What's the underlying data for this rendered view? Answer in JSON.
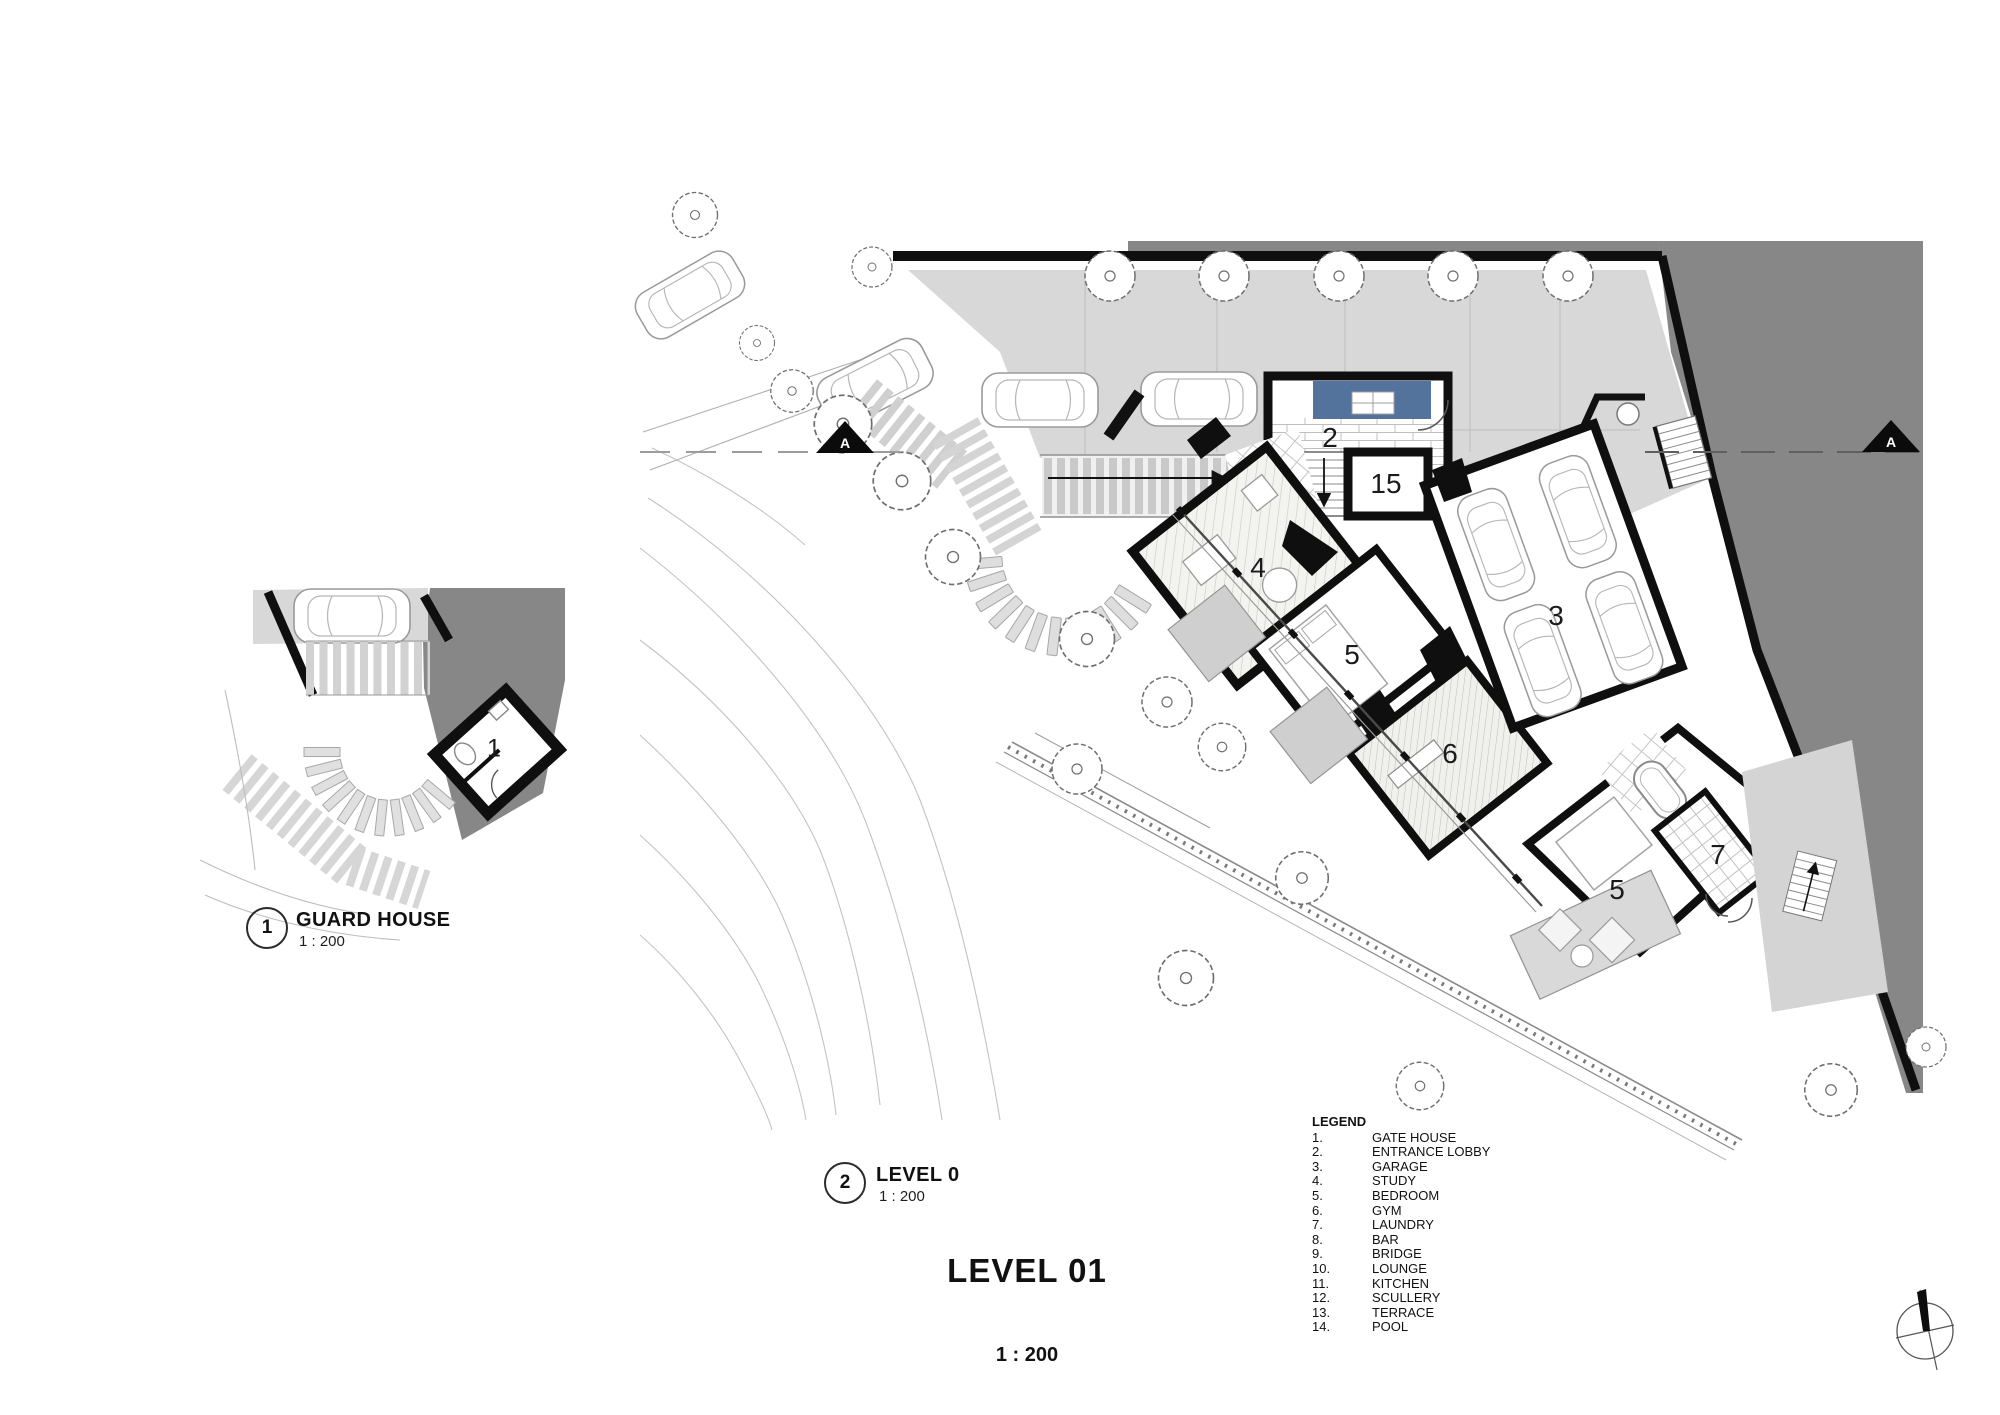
{
  "document": {
    "main_title": "LEVEL 01",
    "main_scale": "1 : 200",
    "views": [
      {
        "ref_number": "1",
        "title": "GUARD HOUSE",
        "scale": "1 : 200"
      },
      {
        "ref_number": "2",
        "title": "LEVEL 0",
        "scale": "1 : 200"
      }
    ],
    "section_marker_label": "A"
  },
  "legend": {
    "title": "LEGEND",
    "items": [
      {
        "number": "1.",
        "label": "GATE HOUSE"
      },
      {
        "number": "2.",
        "label": "ENTRANCE LOBBY"
      },
      {
        "number": "3.",
        "label": "GARAGE"
      },
      {
        "number": "4.",
        "label": "STUDY"
      },
      {
        "number": "5.",
        "label": "BEDROOM"
      },
      {
        "number": "6.",
        "label": "GYM"
      },
      {
        "number": "7.",
        "label": "LAUNDRY"
      },
      {
        "number": "8.",
        "label": "BAR"
      },
      {
        "number": "9.",
        "label": "BRIDGE"
      },
      {
        "number": "10.",
        "label": "LOUNGE"
      },
      {
        "number": "11.",
        "label": "KITCHEN"
      },
      {
        "number": "12.",
        "label": "SCULLERY"
      },
      {
        "number": "13.",
        "label": "TERRACE"
      },
      {
        "number": "14.",
        "label": "POOL"
      }
    ]
  },
  "plan_room_labels": {
    "guard_house": "1",
    "entrance_lobby": "2",
    "stair_core": "15",
    "garage": "3",
    "study": "4",
    "bedroom_mid": "5",
    "gym": "6",
    "bedroom_lower": "5",
    "laundry": "7"
  },
  "colors": {
    "site_dark_gray": "#878787",
    "paving_light_gray": "#d8d8d8",
    "water_feature_blue": "#54739c",
    "wall_black": "#0f0f0f"
  }
}
